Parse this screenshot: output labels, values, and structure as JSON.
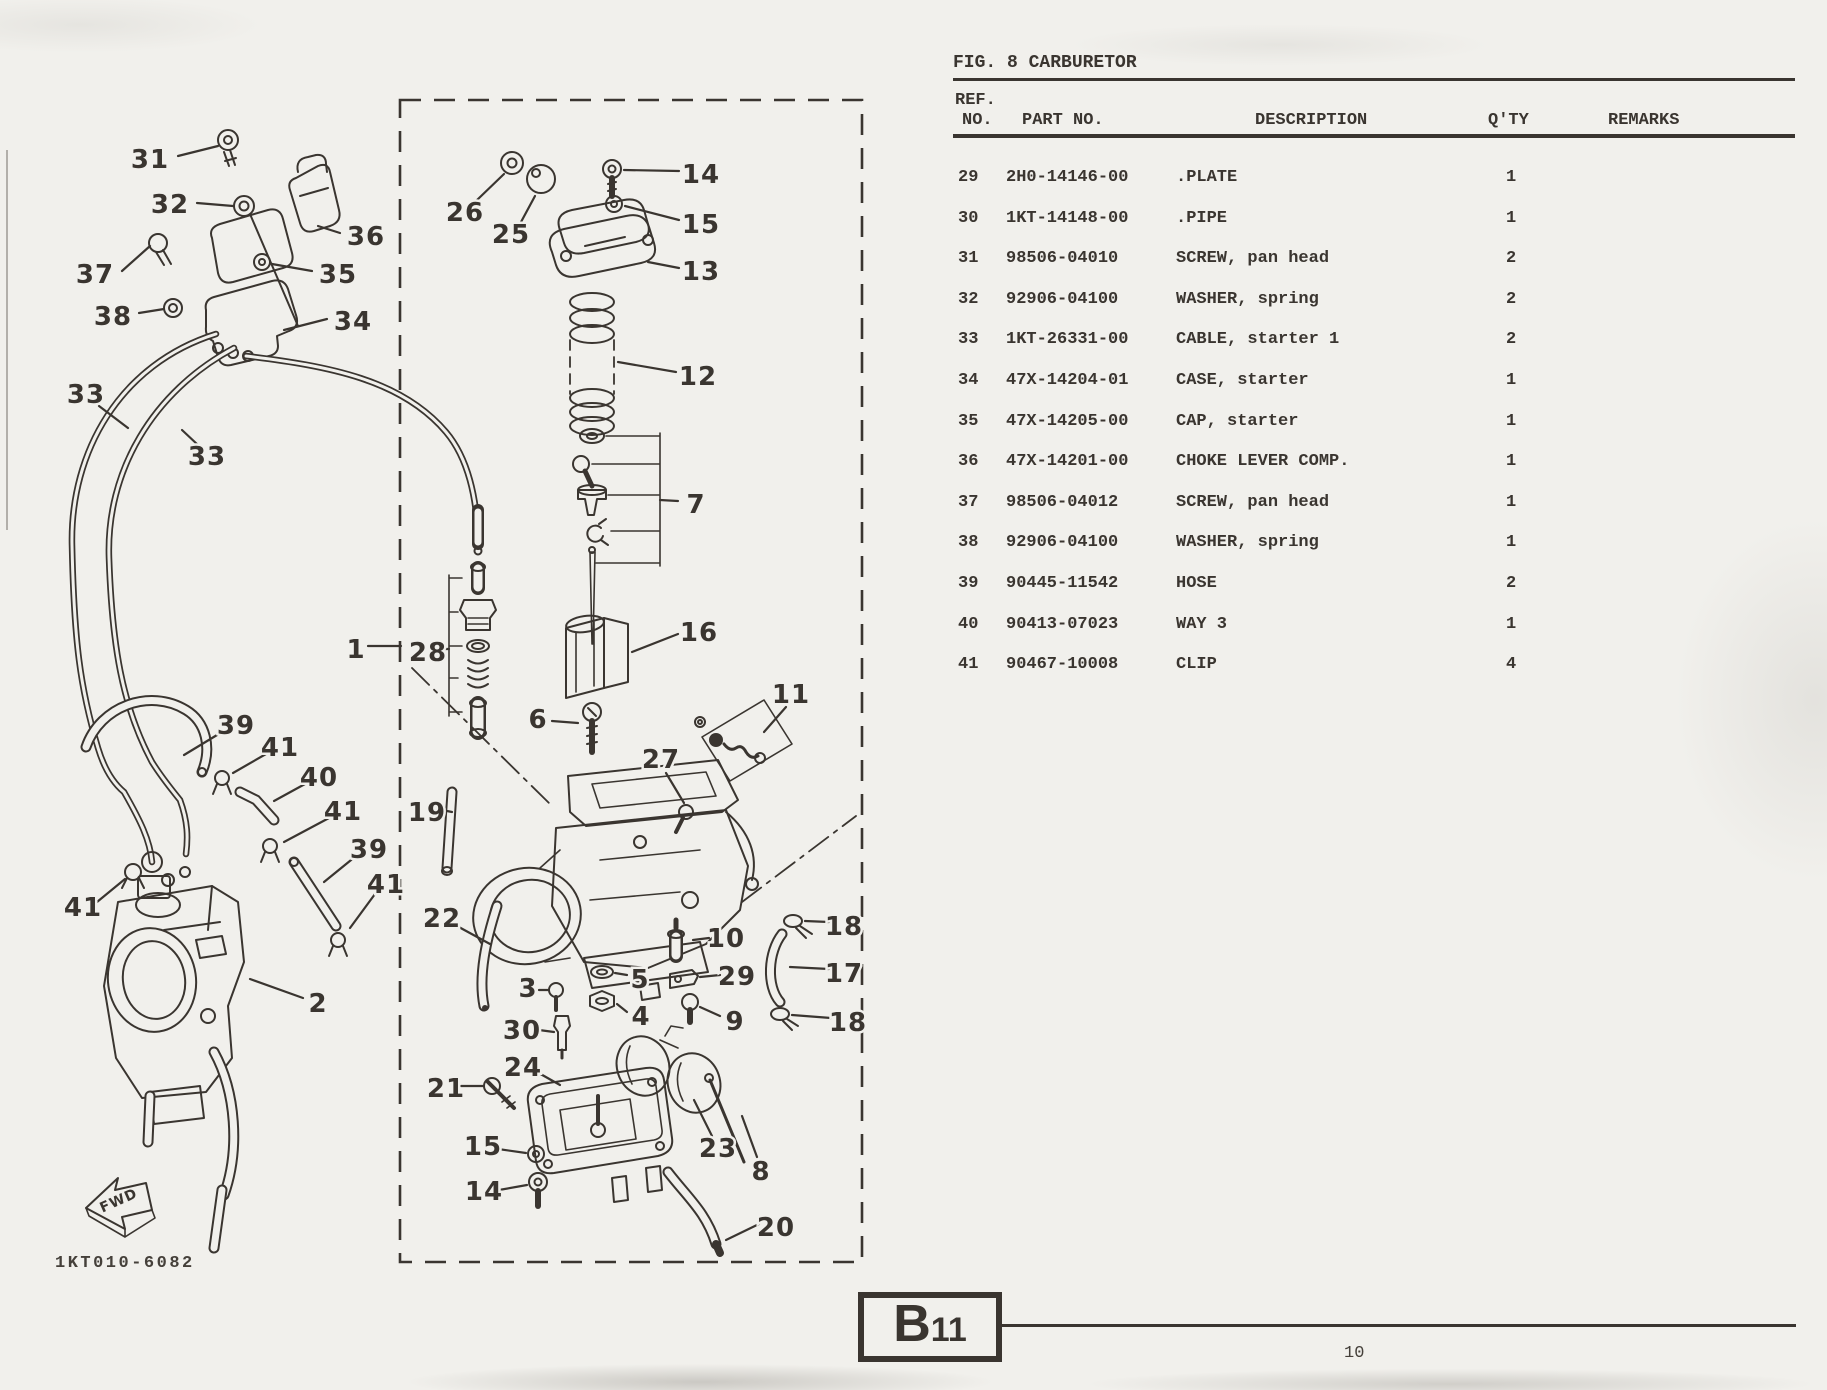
{
  "page": {
    "figure_title": "FIG. 8 CARBURETOR",
    "page_number": "10",
    "section_code": "B11",
    "drawing_number": "1KT010-6082",
    "fwd_label": "FWD"
  },
  "colors": {
    "paper": "#f1f0ec",
    "ink": "#3a3530"
  },
  "table": {
    "headers": {
      "ref_line1": "REF.",
      "ref_line2": "NO.",
      "part_no": "PART NO.",
      "description": "DESCRIPTION",
      "qty": "Q'TY",
      "remarks": "REMARKS"
    },
    "rows": [
      {
        "ref": "29",
        "part_no": "2H0-14146-00",
        "description": ".PLATE",
        "qty": "1",
        "remarks": ""
      },
      {
        "ref": "30",
        "part_no": "1KT-14148-00",
        "description": ".PIPE",
        "qty": "1",
        "remarks": ""
      },
      {
        "ref": "31",
        "part_no": "98506-04010",
        "description": "SCREW, pan head",
        "qty": "2",
        "remarks": ""
      },
      {
        "ref": "32",
        "part_no": "92906-04100",
        "description": "WASHER, spring",
        "qty": "2",
        "remarks": ""
      },
      {
        "ref": "33",
        "part_no": "1KT-26331-00",
        "description": "CABLE, starter 1",
        "qty": "2",
        "remarks": ""
      },
      {
        "ref": "34",
        "part_no": "47X-14204-01",
        "description": "CASE, starter",
        "qty": "1",
        "remarks": ""
      },
      {
        "ref": "35",
        "part_no": "47X-14205-00",
        "description": "CAP, starter",
        "qty": "1",
        "remarks": ""
      },
      {
        "ref": "36",
        "part_no": "47X-14201-00",
        "description": "CHOKE LEVER COMP.",
        "qty": "1",
        "remarks": ""
      },
      {
        "ref": "37",
        "part_no": "98506-04012",
        "description": "SCREW, pan head",
        "qty": "1",
        "remarks": ""
      },
      {
        "ref": "38",
        "part_no": "92906-04100",
        "description": "WASHER, spring",
        "qty": "1",
        "remarks": ""
      },
      {
        "ref": "39",
        "part_no": "90445-11542",
        "description": "HOSE",
        "qty": "2",
        "remarks": ""
      },
      {
        "ref": "40",
        "part_no": "90413-07023",
        "description": "WAY 3",
        "qty": "1",
        "remarks": ""
      },
      {
        "ref": "41",
        "part_no": "90467-10008",
        "description": "CLIP",
        "qty": "4",
        "remarks": ""
      }
    ]
  },
  "diagram": {
    "callouts": [
      {
        "t": "31",
        "x": 150,
        "y": 160,
        "l": [
          178,
          156,
          218,
          146
        ]
      },
      {
        "t": "32",
        "x": 170,
        "y": 205,
        "l": [
          197,
          203,
          233,
          206
        ]
      },
      {
        "t": "36",
        "x": 366,
        "y": 237,
        "l": [
          340,
          233,
          318,
          226
        ]
      },
      {
        "t": "37",
        "x": 95,
        "y": 275,
        "l": [
          122,
          271,
          150,
          246
        ]
      },
      {
        "t": "35",
        "x": 338,
        "y": 275,
        "l": [
          312,
          271,
          272,
          264
        ]
      },
      {
        "t": "38",
        "x": 113,
        "y": 317,
        "l": [
          139,
          313,
          164,
          309
        ]
      },
      {
        "t": "34",
        "x": 353,
        "y": 322,
        "l": [
          327,
          319,
          284,
          330
        ]
      },
      {
        "t": "33",
        "x": 86,
        "y": 395,
        "l": [
          99,
          406,
          128,
          428
        ]
      },
      {
        "t": "33",
        "x": 207,
        "y": 457,
        "l": [
          198,
          445,
          182,
          430
        ]
      },
      {
        "t": "26",
        "x": 465,
        "y": 213,
        "l": [
          477,
          200,
          504,
          174
        ]
      },
      {
        "t": "25",
        "x": 511,
        "y": 235,
        "l": [
          521,
          222,
          535,
          196
        ]
      },
      {
        "t": "14",
        "x": 701,
        "y": 175,
        "l": [
          679,
          171,
          624,
          170
        ]
      },
      {
        "t": "15",
        "x": 701,
        "y": 225,
        "l": [
          679,
          220,
          625,
          206
        ]
      },
      {
        "t": "13",
        "x": 701,
        "y": 272,
        "l": [
          679,
          268,
          648,
          262
        ]
      },
      {
        "t": "12",
        "x": 698,
        "y": 377,
        "l": [
          676,
          372,
          618,
          362
        ]
      },
      {
        "t": "7",
        "x": 696,
        "y": 505,
        "l": [
          660,
          500,
          678,
          501
        ]
      },
      {
        "t": "16",
        "x": 699,
        "y": 633,
        "l": [
          678,
          634,
          632,
          652
        ]
      },
      {
        "t": "1",
        "x": 356,
        "y": 650,
        "l": [
          368,
          646,
          401,
          646
        ]
      },
      {
        "t": "28",
        "x": 428,
        "y": 653,
        "l": [
          441,
          649,
          449,
          649
        ]
      },
      {
        "t": "6",
        "x": 538,
        "y": 720,
        "l": [
          552,
          721,
          578,
          723
        ]
      },
      {
        "t": "11",
        "x": 791,
        "y": 695,
        "l": [
          786,
          707,
          764,
          732
        ]
      },
      {
        "t": "27",
        "x": 661,
        "y": 760,
        "l": [
          666,
          773,
          684,
          803
        ]
      },
      {
        "t": "19",
        "x": 427,
        "y": 813,
        "l": [
          442,
          810,
          452,
          812
        ]
      },
      {
        "t": "22",
        "x": 442,
        "y": 919,
        "l": [
          457,
          926,
          490,
          944
        ]
      },
      {
        "t": "3",
        "x": 528,
        "y": 989,
        "l": [
          539,
          990,
          548,
          990
        ]
      },
      {
        "t": "30",
        "x": 522,
        "y": 1031,
        "l": [
          539,
          1030,
          554,
          1032
        ]
      },
      {
        "t": "5",
        "x": 640,
        "y": 980,
        "l": [
          627,
          975,
          615,
          973
        ]
      },
      {
        "t": "4",
        "x": 641,
        "y": 1017,
        "l": [
          627,
          1012,
          617,
          1004
        ]
      },
      {
        "t": "10",
        "x": 726,
        "y": 939,
        "l": [
          709,
          938,
          693,
          940
        ]
      },
      {
        "t": "29",
        "x": 737,
        "y": 977,
        "l": [
          720,
          975,
          700,
          977
        ]
      },
      {
        "t": "9",
        "x": 735,
        "y": 1022,
        "l": [
          720,
          1016,
          700,
          1007
        ]
      },
      {
        "t": "18",
        "x": 844,
        "y": 927,
        "l": [
          829,
          922,
          805,
          921
        ]
      },
      {
        "t": "17",
        "x": 844,
        "y": 974,
        "l": [
          829,
          969,
          790,
          967
        ]
      },
      {
        "t": "18",
        "x": 848,
        "y": 1023,
        "l": [
          831,
          1018,
          792,
          1015
        ]
      },
      {
        "t": "23",
        "x": 718,
        "y": 1149,
        "l": [
          712,
          1136,
          694,
          1100
        ]
      },
      {
        "t": "8",
        "x": 761,
        "y": 1172,
        "l": [
          757,
          1157,
          742,
          1116
        ]
      },
      {
        "t": "20",
        "x": 776,
        "y": 1228,
        "l": [
          759,
          1224,
          726,
          1240
        ]
      },
      {
        "t": "24",
        "x": 523,
        "y": 1068,
        "l": [
          537,
          1072,
          560,
          1085
        ]
      },
      {
        "t": "21",
        "x": 446,
        "y": 1089,
        "l": [
          461,
          1086,
          483,
          1086
        ]
      },
      {
        "t": "15",
        "x": 483,
        "y": 1147,
        "l": [
          498,
          1149,
          526,
          1153
        ]
      },
      {
        "t": "14",
        "x": 484,
        "y": 1192,
        "l": [
          499,
          1190,
          527,
          1185
        ]
      },
      {
        "t": "2",
        "x": 318,
        "y": 1004,
        "l": [
          303,
          998,
          250,
          979
        ]
      },
      {
        "t": "39",
        "x": 236,
        "y": 726,
        "l": [
          222,
          732,
          184,
          755
        ]
      },
      {
        "t": "41",
        "x": 280,
        "y": 748,
        "l": [
          266,
          754,
          233,
          773
        ]
      },
      {
        "t": "40",
        "x": 319,
        "y": 778,
        "l": [
          305,
          784,
          274,
          801
        ]
      },
      {
        "t": "41",
        "x": 343,
        "y": 812,
        "l": [
          329,
          818,
          284,
          842
        ]
      },
      {
        "t": "39",
        "x": 369,
        "y": 850,
        "l": [
          356,
          856,
          324,
          882
        ]
      },
      {
        "t": "41",
        "x": 386,
        "y": 885,
        "l": [
          375,
          894,
          350,
          928
        ]
      },
      {
        "t": "41",
        "x": 83,
        "y": 908,
        "l": [
          97,
          902,
          125,
          879
        ]
      }
    ]
  }
}
